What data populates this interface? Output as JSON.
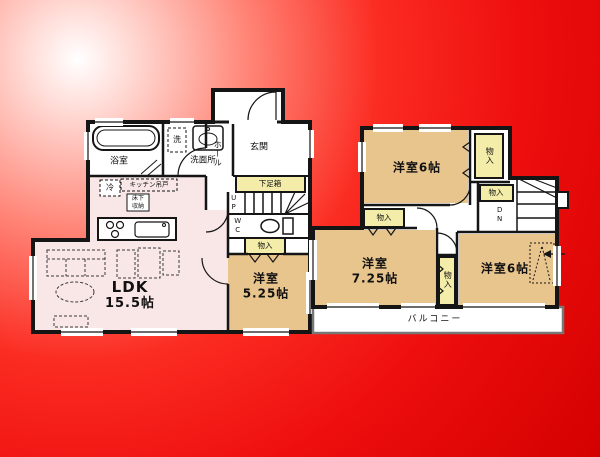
{
  "colors": {
    "wall": "#151515",
    "white": "#ffffff",
    "pink": "#f8e7e6",
    "tan": "#e9c58e",
    "yellow": "#f3eda9",
    "balcony_border": "#777777",
    "bg_center": "#ffffff",
    "bg_mid": "#fb2c22",
    "bg_edge": "#d40000"
  },
  "floor1": {
    "bath": "浴室",
    "washer": "洗",
    "washroom": "洗面所",
    "hall": "ホール",
    "entrance": "玄関",
    "shoebox": "下足箱",
    "stairs_up": "UP",
    "wc": "WC",
    "closet": "物入",
    "fridge": "冷",
    "kitchen_shelf": "キッチン吊戸",
    "floor_storage_1": "床下",
    "floor_storage_2": "収納",
    "ldk_name": "LDK",
    "ldk_size": "15.5帖",
    "bedroom_name": "洋室",
    "bedroom_size": "5.25帖"
  },
  "floor2": {
    "bedroom_a": "洋室6帖",
    "closet_a": "物入",
    "closet_b": "物入",
    "stairs_dn": "DN",
    "closet_c": "物入",
    "bedroom_b_name": "洋室",
    "bedroom_b_size": "7.25帖",
    "closet_d": "物入",
    "bedroom_c": "洋室6帖",
    "balcony": "バルコニー"
  }
}
